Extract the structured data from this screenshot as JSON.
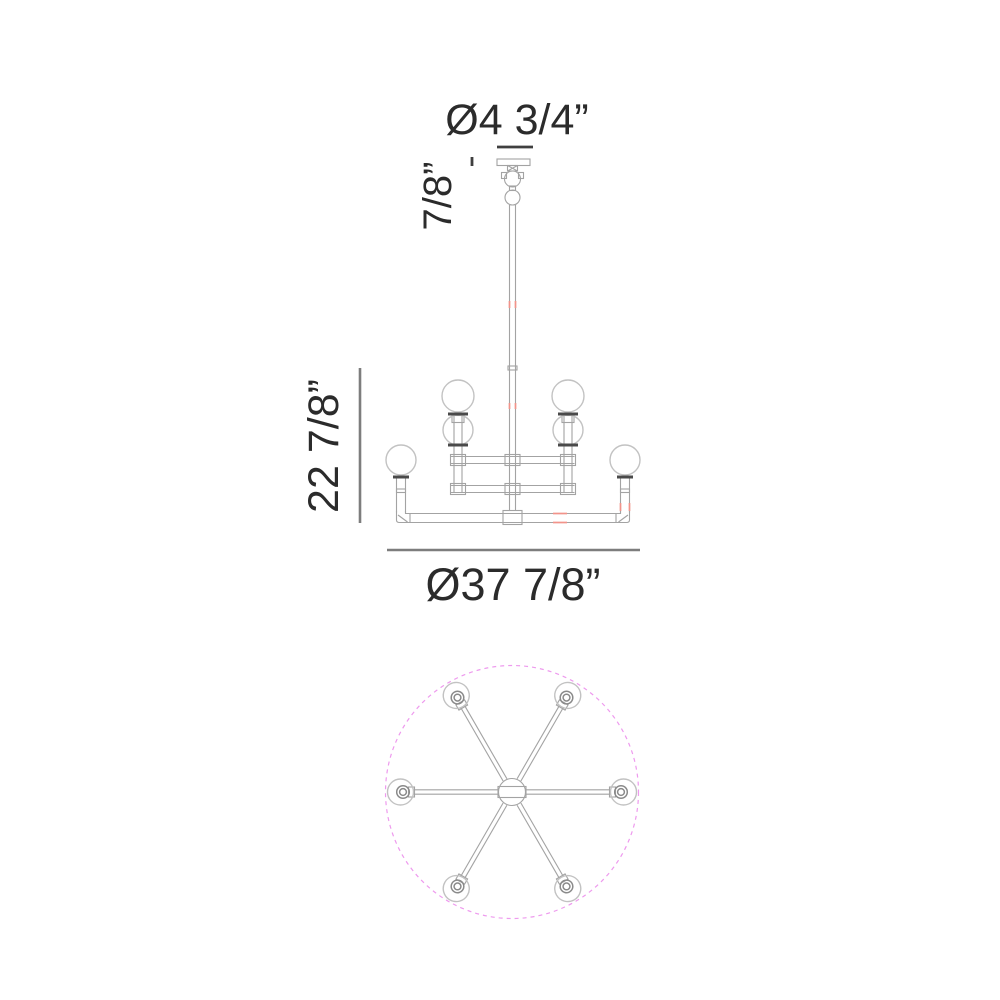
{
  "labels": {
    "canopy_diameter": "Ø4 3/4”",
    "canopy_height": "7/8”",
    "fixture_height": "22 7/8”",
    "fixture_diameter": "Ø37 7/8”"
  },
  "colors": {
    "line": "#a3a3a3",
    "globe": "#c2c2c2",
    "ring": "#8a8a8a",
    "dark": "#4a4a4a",
    "text": "#2b2b2b",
    "dim": "#7d7d7d",
    "dim_dark": "#3f3f3f",
    "red": "#f2938a",
    "magenta": "#ee9aee"
  }
}
